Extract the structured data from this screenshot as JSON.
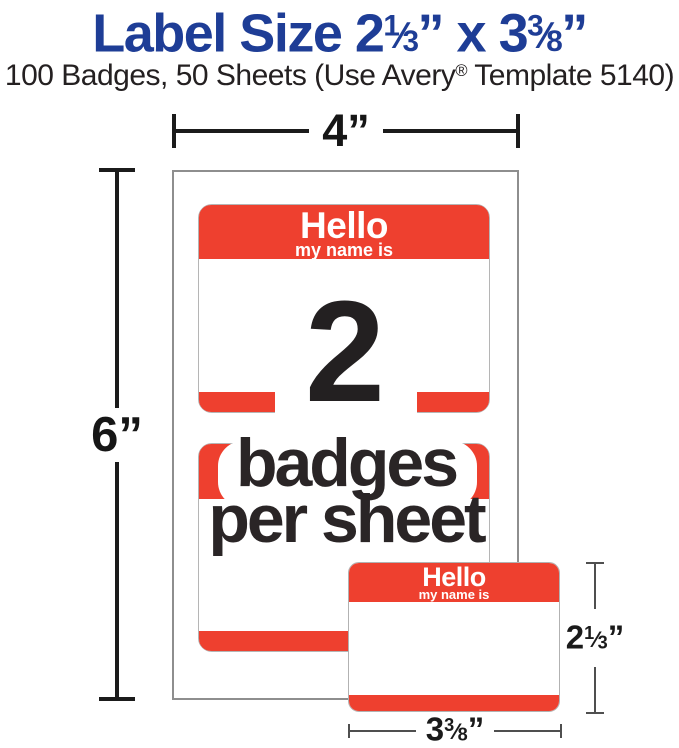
{
  "header": {
    "title": {
      "pre": "Label Size 2",
      "frac1": {
        "num": "1",
        "den": "3"
      },
      "mid": "” x 3",
      "frac2": {
        "num": "3",
        "den": "8"
      },
      "post": "”"
    },
    "subtitle": {
      "pre": "100 Badges, 50 Sheets (Use Avery",
      "reg": "®",
      "post": " Template 5140)"
    }
  },
  "glyphs": {
    "fraction_slash": "⁄"
  },
  "dimensions": {
    "sheet_width": {
      "value": "4",
      "unit": "”"
    },
    "sheet_height": {
      "value": "6",
      "unit": "”"
    },
    "badge_height": {
      "int": "2",
      "num": "1",
      "den": "3",
      "unit": "”"
    },
    "badge_width": {
      "int": "3",
      "num": "3",
      "den": "8",
      "unit": "”"
    }
  },
  "sheet": {
    "badge": {
      "hello": "Hello",
      "subtext": "my name is"
    },
    "count": "2",
    "caption": {
      "line1": "badges",
      "line2": "per sheet"
    }
  },
  "colors": {
    "badge_red": "#ee402f",
    "title_blue": "#1e3d96",
    "text_dark": "#242021",
    "dimension_line_bold": "#1b1b1b",
    "dimension_line_thin": "#4f4f4f",
    "sheet_border": "#8e8e8e",
    "badge_outline": "#b5b5b5"
  }
}
